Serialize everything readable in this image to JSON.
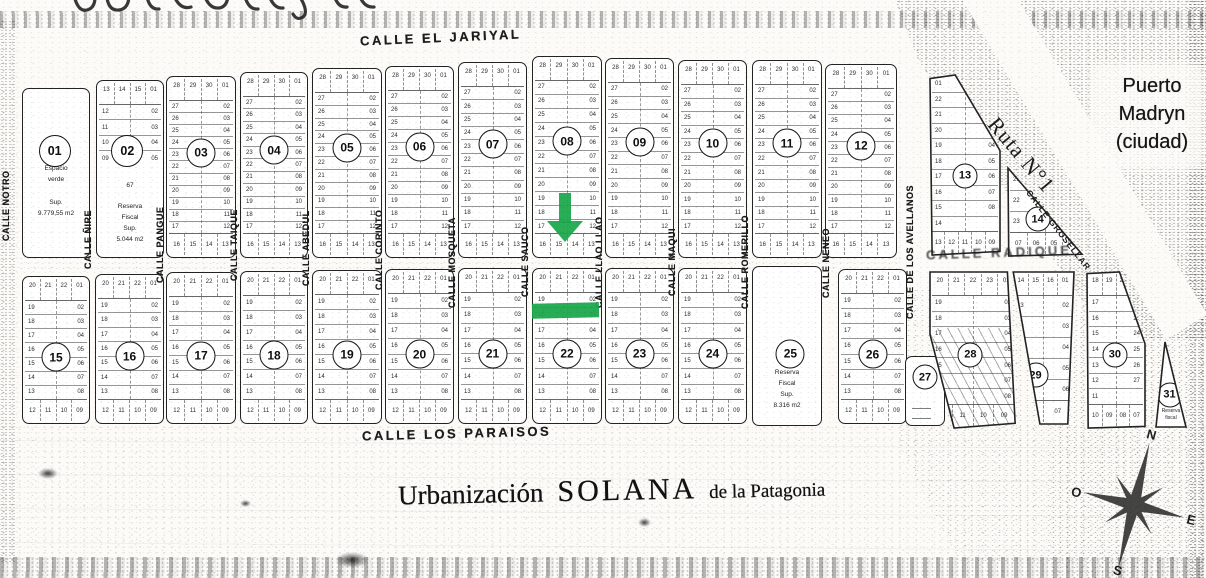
{
  "document": {
    "title": {
      "part1": "Urbanización",
      "part2": "SOLANA",
      "part3": "de la Patagonia"
    },
    "city_label": {
      "line1": "Puerto",
      "line2": "Madryn",
      "line3": "(ciudad)"
    },
    "route_label": "Ruta N°1",
    "diagonal_street": "CALLE GROSELLAR",
    "compass": {
      "n": "N",
      "e": "E",
      "s": "S",
      "o": "O"
    }
  },
  "colors": {
    "ink": "#1f1f1f",
    "paper": "#fcfbf8",
    "annotation_green": "#1ca84c",
    "highlight_pink": "rgba(236,130,130,0.33)"
  },
  "annotations": {
    "arrow": {
      "shape": "down-arrow",
      "color": "#1ca84c",
      "x": 547,
      "y": 193,
      "w": 36,
      "h": 49
    },
    "bar": {
      "shape": "highlight-bar",
      "color": "#1ca84c",
      "x": 532,
      "y": 303,
      "w": 67,
      "h": 15
    }
  },
  "streets_h": [
    {
      "id": "jariyal",
      "label": "CALLE EL JARIYAL",
      "x": 360,
      "y": 30,
      "rot": -2.5,
      "degraded": false
    },
    {
      "id": "paraisos",
      "label": "CALLE  LOS PARAISOS",
      "x": 362,
      "y": 426,
      "rot": -1.5,
      "degraded": false
    },
    {
      "id": "radique",
      "label": "CALLE RADIQUE",
      "x": 926,
      "y": 245,
      "rot": -2,
      "degraded": true
    }
  ],
  "streets_v": [
    {
      "label": "CALLE NOTRO",
      "x": 8,
      "y": 205,
      "h": 125
    },
    {
      "label": "CALLE ÑIRE",
      "x": 90,
      "y": 240,
      "h": 170
    },
    {
      "label": "CALLE PANGUE",
      "x": 162,
      "y": 245,
      "h": 170
    },
    {
      "label": "CALLE TAIQUE",
      "x": 236,
      "y": 245,
      "h": 170
    },
    {
      "label": "CALLE ABEDUL",
      "x": 308,
      "y": 248,
      "h": 170
    },
    {
      "label": "CALLE CORINTO",
      "x": 381,
      "y": 250,
      "h": 170
    },
    {
      "label": "CALLE MOSQUETA",
      "x": 454,
      "y": 262,
      "h": 175
    },
    {
      "label": "CALLE SAUCO",
      "x": 527,
      "y": 262,
      "h": 170
    },
    {
      "label": "CALLE LLAO LLAO",
      "x": 601,
      "y": 262,
      "h": 175
    },
    {
      "label": "CALLE MAQUI",
      "x": 674,
      "y": 262,
      "h": 165
    },
    {
      "label": "CALLE ROMERILLO",
      "x": 747,
      "y": 262,
      "h": 175
    },
    {
      "label": "CALLE NENEO",
      "x": 828,
      "y": 262,
      "h": 165
    },
    {
      "label": "CALLE DE LOS AVELLANOS",
      "x": 912,
      "y": 252,
      "h": 200
    }
  ],
  "lot_patterns": {
    "tall": {
      "top": [
        "28",
        "29",
        "30",
        "01"
      ],
      "left": [
        "27",
        "26",
        "25",
        "24",
        "23",
        "22",
        "21",
        "20",
        "19",
        "18",
        "17"
      ],
      "right": [
        "02",
        "03",
        "04",
        "05",
        "06",
        "07",
        "08",
        "09",
        "10",
        "11",
        "12"
      ],
      "bottom": [
        "16",
        "15",
        "14",
        "13"
      ]
    },
    "short": {
      "top": [
        "20",
        "21",
        "22",
        "01"
      ],
      "left": [
        "19",
        "18",
        "17",
        "16",
        "15",
        "14",
        "13"
      ],
      "right": [
        "02",
        "03",
        "04",
        "05",
        "06",
        "07",
        "08"
      ],
      "bottom": [
        "12",
        "11",
        "10",
        "09"
      ]
    },
    "p02": {
      "top": [
        "13",
        "14",
        "15",
        "01"
      ],
      "left": [
        "12",
        "11",
        "10",
        "09"
      ],
      "right": [
        "02",
        "03",
        "04",
        "05"
      ],
      "bottom": []
    },
    "p13": {
      "top": [],
      "left": [
        "01",
        "22",
        "21",
        "20",
        "19",
        "18",
        "17",
        "16",
        "15",
        "14"
      ],
      "right": [
        "",
        "",
        "02",
        "03",
        "04",
        "05",
        "06",
        "07",
        "08",
        ""
      ],
      "bottom": [
        "13",
        "12",
        "11",
        "10",
        "09"
      ]
    },
    "p14": {
      "top": [],
      "left": [
        "21",
        "22",
        "23"
      ],
      "right": [
        "",
        "",
        ""
      ],
      "bottom": [
        "07",
        "06",
        "05",
        "04"
      ]
    },
    "p28": {
      "top": [
        "20",
        "21",
        "22",
        "23",
        "01"
      ],
      "left": [
        "19",
        "18",
        "17",
        "16",
        "15",
        "14",
        "13"
      ],
      "right": [
        "02",
        "03",
        "04",
        "05",
        "06",
        "07",
        "08"
      ],
      "bottom": [
        "12",
        "11",
        "10",
        "09"
      ]
    },
    "p29": {
      "top": [
        "14",
        "15",
        "16",
        "01"
      ],
      "left": [
        "13",
        "12",
        "11",
        "10",
        "09"
      ],
      "right": [
        "02",
        "03",
        "04",
        "05",
        "06"
      ],
      "bottom": [
        "08",
        "07"
      ]
    },
    "p30": {
      "top": [
        "18",
        "19",
        "20",
        "21"
      ],
      "left": [
        "17",
        "16",
        "15",
        "14",
        "13",
        "12",
        "11"
      ],
      "right": [
        "22",
        "23",
        "24",
        "25",
        "26",
        "27"
      ],
      "bottom": [
        "10",
        "09",
        "08",
        "07"
      ]
    }
  },
  "blocks": [
    {
      "id": "01",
      "kind": "green",
      "x": 22,
      "y": 88,
      "w": 66,
      "h": 168,
      "cx": 48,
      "cy": 37,
      "note": [
        "Espacio",
        "verde"
      ],
      "note2": [
        "Sup.",
        "9.779,55 m2"
      ]
    },
    {
      "id": "02",
      "kind": "mixed",
      "x": 96,
      "y": 80,
      "w": 66,
      "h": 176,
      "cx": 46,
      "cy": 40,
      "pattern": "p02",
      "note": [
        "67"
      ],
      "note2": [
        "Reserva",
        "Fiscal",
        "Sup.",
        "5.044 m2"
      ]
    },
    {
      "id": "03",
      "kind": "tall",
      "x": 166,
      "y": 76,
      "w": 68,
      "h": 180,
      "pattern": "tall"
    },
    {
      "id": "04",
      "kind": "tall",
      "x": 240,
      "y": 72,
      "w": 66,
      "h": 184,
      "pattern": "tall"
    },
    {
      "id": "05",
      "kind": "tall",
      "x": 312,
      "y": 68,
      "w": 68,
      "h": 188,
      "pattern": "tall"
    },
    {
      "id": "06",
      "kind": "tall",
      "x": 385,
      "y": 66,
      "w": 67,
      "h": 190,
      "pattern": "tall"
    },
    {
      "id": "07",
      "kind": "tall",
      "x": 458,
      "y": 62,
      "w": 67,
      "h": 194,
      "pattern": "tall"
    },
    {
      "id": "08",
      "kind": "tall",
      "x": 532,
      "y": 56,
      "w": 68,
      "h": 200,
      "pattern": "tall"
    },
    {
      "id": "09",
      "kind": "tall",
      "x": 605,
      "y": 58,
      "w": 67,
      "h": 198,
      "pattern": "tall"
    },
    {
      "id": "10",
      "kind": "tall",
      "x": 678,
      "y": 60,
      "w": 67,
      "h": 196,
      "pattern": "tall"
    },
    {
      "id": "11",
      "kind": "tall",
      "x": 752,
      "y": 60,
      "w": 68,
      "h": 196,
      "pattern": "tall"
    },
    {
      "id": "12",
      "kind": "tall",
      "x": 825,
      "y": 64,
      "w": 70,
      "h": 192,
      "pattern": "tall"
    },
    {
      "id": "13",
      "kind": "p13",
      "x": 930,
      "y": 75,
      "w": 70,
      "h": 180,
      "cx": 50,
      "cy": 56,
      "pattern": "p13"
    },
    {
      "id": "14",
      "kind": "p14",
      "x": 1008,
      "y": 168,
      "w": 74,
      "h": 88,
      "cx": 40,
      "cy": 58,
      "pattern": "p14"
    },
    {
      "id": "15",
      "kind": "short",
      "x": 22,
      "y": 276,
      "w": 66,
      "h": 146,
      "pattern": "short"
    },
    {
      "id": "16",
      "kind": "short",
      "x": 95,
      "y": 274,
      "w": 67,
      "h": 148,
      "pattern": "short"
    },
    {
      "id": "17",
      "kind": "short",
      "x": 166,
      "y": 272,
      "w": 68,
      "h": 150,
      "pattern": "short"
    },
    {
      "id": "18",
      "kind": "short",
      "x": 240,
      "y": 271,
      "w": 66,
      "h": 151,
      "pattern": "short"
    },
    {
      "id": "19",
      "kind": "short",
      "x": 312,
      "y": 270,
      "w": 68,
      "h": 152,
      "pattern": "short"
    },
    {
      "id": "20",
      "kind": "short",
      "x": 385,
      "y": 269,
      "w": 67,
      "h": 153,
      "pattern": "short"
    },
    {
      "id": "21",
      "kind": "short",
      "x": 458,
      "y": 268,
      "w": 67,
      "h": 154,
      "pattern": "short"
    },
    {
      "id": "22",
      "kind": "short",
      "x": 532,
      "y": 268,
      "w": 68,
      "h": 154,
      "pattern": "short"
    },
    {
      "id": "23",
      "kind": "short",
      "x": 605,
      "y": 268,
      "w": 67,
      "h": 154,
      "pattern": "short"
    },
    {
      "id": "24",
      "kind": "short",
      "x": 678,
      "y": 268,
      "w": 67,
      "h": 154,
      "pattern": "short"
    },
    {
      "id": "25",
      "kind": "reserve",
      "x": 752,
      "y": 266,
      "w": 68,
      "h": 158,
      "cx": 55,
      "cy": 55,
      "note2": [
        "Reserva",
        "Fiscal",
        "Sup.",
        "8.316 m2"
      ]
    },
    {
      "id": "26",
      "kind": "short",
      "x": 838,
      "y": 269,
      "w": 67,
      "h": 153,
      "pattern": "short"
    },
    {
      "id": "27",
      "kind": "tiny",
      "x": 905,
      "y": 356,
      "w": 38,
      "h": 68,
      "cx": 50,
      "cy": 30
    },
    {
      "id": "28",
      "kind": "p28",
      "x": 930,
      "y": 272,
      "w": 86,
      "h": 156,
      "cx": 47,
      "cy": 53,
      "pattern": "p28"
    },
    {
      "id": "29",
      "kind": "p29",
      "x": 1012,
      "y": 272,
      "w": 62,
      "h": 152,
      "cx": 38,
      "cy": 68,
      "pattern": "p29"
    },
    {
      "id": "30",
      "kind": "p30",
      "x": 1087,
      "y": 272,
      "w": 58,
      "h": 156,
      "cx": 48,
      "cy": 53,
      "pattern": "p30"
    },
    {
      "id": "31",
      "kind": "p31",
      "x": 1156,
      "y": 342,
      "w": 30,
      "h": 85,
      "cx": 45,
      "cy": 62,
      "note2": [
        "Reserva",
        "fiscal"
      ]
    }
  ],
  "highlights": [
    {
      "x": 213,
      "y": 118,
      "w": 20,
      "h": 11,
      "color": "rgba(236,130,130,0.33)"
    },
    {
      "x": 186,
      "y": 224,
      "w": 17,
      "h": 22,
      "color": "rgba(236,130,130,0.28)"
    },
    {
      "x": 196,
      "y": 396,
      "w": 16,
      "h": 26,
      "color": "rgba(236,130,130,0.3)"
    },
    {
      "x": 282,
      "y": 333,
      "w": 20,
      "h": 11,
      "color": "rgba(236,130,130,0.3)"
    },
    {
      "x": 330,
      "y": 396,
      "w": 16,
      "h": 26,
      "color": "rgba(236,130,130,0.3)"
    },
    {
      "x": 128,
      "y": 317,
      "w": 34,
      "h": 13,
      "color": "rgba(168,186,176,0.45)"
    }
  ]
}
